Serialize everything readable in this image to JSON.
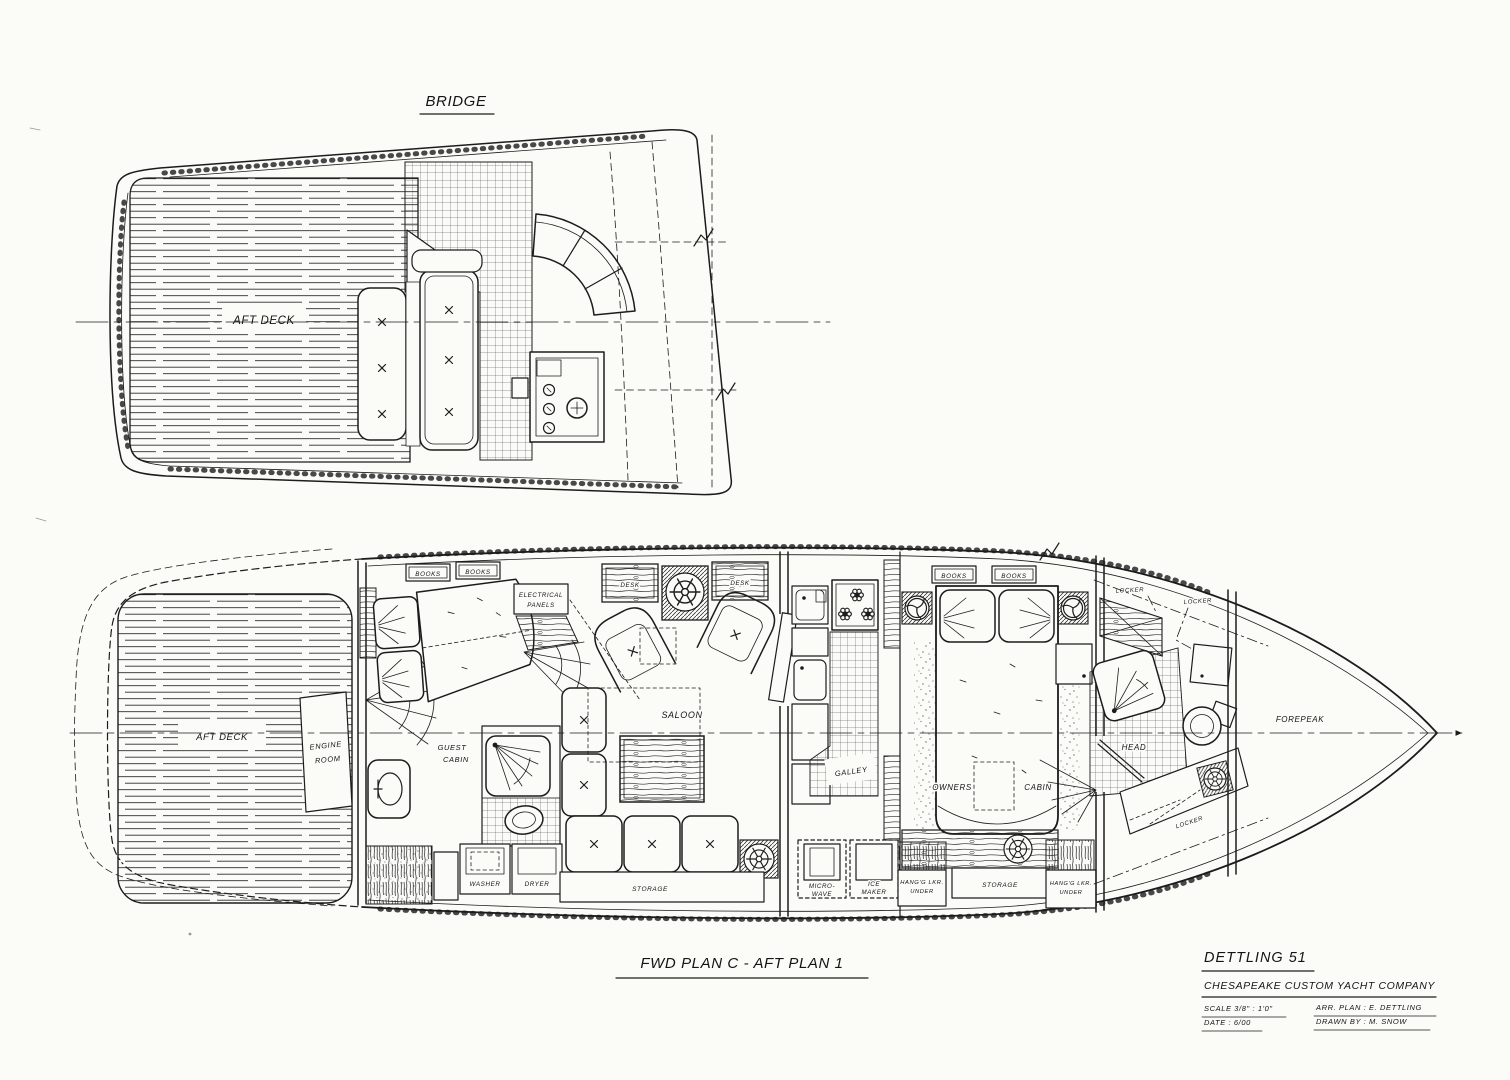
{
  "drawing": {
    "bridge": {
      "title": "BRIDGE",
      "aft_deck": "AFT DECK"
    },
    "main": {
      "caption": "FWD PLAN C - AFT PLAN 1",
      "aft_deck": "AFT DECK",
      "engine_room": [
        "ENGINE",
        "ROOM"
      ],
      "guest_cabin": [
        "GUEST",
        "CABIN"
      ],
      "books": "BOOKS",
      "electrical_panels": [
        "ELECTRICAL",
        "PANELS"
      ],
      "desk": "DESK",
      "saloon": "SALOON",
      "galley": "GALLEY",
      "washer": "WASHER",
      "dryer": "DRYER",
      "storage": "STORAGE",
      "microwave": [
        "MICRO-",
        "WAVE"
      ],
      "ice_maker": [
        "ICE",
        "MAKER"
      ],
      "hanging_locker": [
        "HANG'G LKR.",
        "UNDER"
      ],
      "owners_cabin": [
        "OWNERS",
        "CABIN"
      ],
      "locker": "LOCKER",
      "head": "HEAD",
      "forepeak": "FOREPEAK"
    },
    "title_block": {
      "model": "DETTLING 51",
      "company": "CHESAPEAKE CUSTOM YACHT COMPANY",
      "scale": "SCALE 3/8\" : 1'0\"",
      "date": "DATE : 6/00",
      "arr_plan": "ARR. PLAN : E. DETTLING",
      "drawn_by": "DRAWN BY : M. SNOW"
    },
    "colors": {
      "ink": "#1c1c1c",
      "paper": "#fbfbf8"
    }
  }
}
